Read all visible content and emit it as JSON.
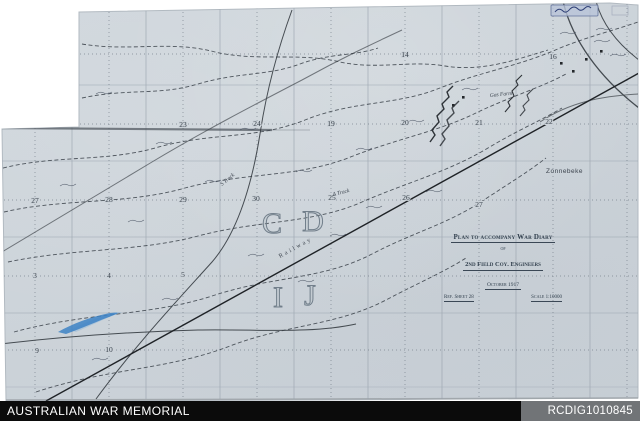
{
  "footer": {
    "archive_name": "AUSTRALIAN WAR MEMORIAL",
    "item_id": "RCDIG1010845"
  },
  "title_block": {
    "line1": "Plan to accompany War Diary",
    "line2": "of",
    "line3": "2nd Field Coy. Engineers",
    "line4": "October 1917",
    "ref": "Ref. Sheet 28",
    "scale": "Scale 1:10000"
  },
  "map": {
    "colors": {
      "paper": "#ccd3d9",
      "grid_line": "#97a1ac",
      "ink": "#3a424c",
      "water_blue": "#3d82c4",
      "stamp_blue": "#2e3f76"
    },
    "square_letters": [
      {
        "label": "C",
        "x": 272,
        "y": 233
      },
      {
        "label": "D",
        "x": 313,
        "y": 231
      },
      {
        "label": "I",
        "x": 278,
        "y": 307
      },
      {
        "label": "J",
        "x": 310,
        "y": 305
      }
    ],
    "grid_numbers": [
      {
        "label": "14",
        "x": 405,
        "y": 57
      },
      {
        "label": "16",
        "x": 553,
        "y": 59
      },
      {
        "label": "23",
        "x": 183,
        "y": 127
      },
      {
        "label": "24",
        "x": 257,
        "y": 126
      },
      {
        "label": "19",
        "x": 331,
        "y": 126
      },
      {
        "label": "20",
        "x": 405,
        "y": 125
      },
      {
        "label": "21",
        "x": 479,
        "y": 125
      },
      {
        "label": "22",
        "x": 549,
        "y": 124
      },
      {
        "label": "27",
        "x": 35,
        "y": 203
      },
      {
        "label": "28",
        "x": 109,
        "y": 202
      },
      {
        "label": "29",
        "x": 183,
        "y": 202
      },
      {
        "label": "30",
        "x": 256,
        "y": 201
      },
      {
        "label": "25",
        "x": 332,
        "y": 200
      },
      {
        "label": "26",
        "x": 406,
        "y": 200
      },
      {
        "label": "27",
        "x": 479,
        "y": 207
      },
      {
        "label": "3",
        "x": 35,
        "y": 278
      },
      {
        "label": "4",
        "x": 109,
        "y": 278
      },
      {
        "label": "5",
        "x": 183,
        "y": 277
      },
      {
        "label": "9",
        "x": 37,
        "y": 353
      },
      {
        "label": "10",
        "x": 109,
        "y": 352
      }
    ],
    "place_labels": [
      {
        "text": "Zonnebeke",
        "x": 546,
        "y": 173,
        "size": 6.5,
        "rot": 0,
        "italic": false,
        "ls": 0.5,
        "sans": true
      },
      {
        "text": "Gas Farm",
        "x": 490,
        "y": 97,
        "size": 5.5,
        "rot": -6,
        "italic": true,
        "ls": 0,
        "sans": false
      },
      {
        "text": "A Track",
        "x": 333,
        "y": 196,
        "size": 5.5,
        "rot": -14,
        "italic": true,
        "ls": 0,
        "sans": false
      },
      {
        "text": "S Track",
        "x": 222,
        "y": 186,
        "size": 5.5,
        "rot": -40,
        "italic": true,
        "ls": 0,
        "sans": false
      },
      {
        "text": "Railway",
        "x": 280,
        "y": 258,
        "size": 6,
        "rot": -29,
        "italic": false,
        "ls": 2.5,
        "sans": false
      }
    ]
  }
}
